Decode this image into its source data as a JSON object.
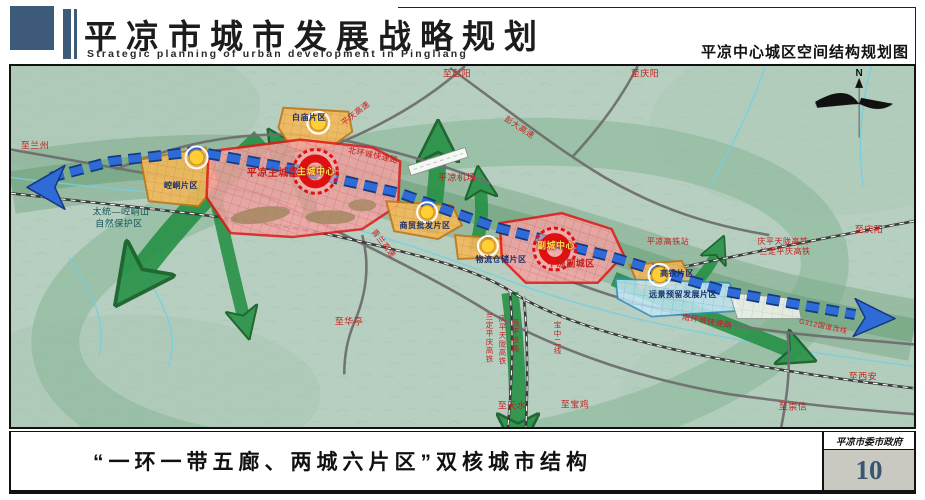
{
  "colors": {
    "red": "#c41f1f",
    "navy": "#1b2f6b",
    "yellow": "#ffe14d",
    "teal": "#15555a",
    "black": "#111111",
    "header_slate": "#3d5b78",
    "page_box_gray": "#c9c9c2",
    "page_number_blue": "#3a5570",
    "zone_orange": "#f3b95c",
    "zone_pink": "#f2a3a3",
    "zone_blue": "#c3e6f4",
    "corridor_green": "#249043",
    "belt_blue": "#2e6bd6"
  },
  "header": {
    "title_cn": "平凉市城市发展战略规划",
    "title_en": "Strategic planning of urban development in Pingliang",
    "map_title": "平凉中心城区空间结构规划图"
  },
  "footer": {
    "caption": "“一环一带五廊、两城六片区”双核城市结构",
    "agency": "平凉市委市政府",
    "page_number": "10"
  },
  "map": {
    "compass": "N",
    "labels": [
      {
        "text": "至兰州",
        "x": 24,
        "y": 80,
        "color": "red",
        "size": 9
      },
      {
        "text": "太统—崆峒山",
        "x": 110,
        "y": 146,
        "color": "teal",
        "size": 9
      },
      {
        "text": "自然保护区",
        "x": 108,
        "y": 158,
        "color": "teal",
        "size": 9
      },
      {
        "text": "崆峒片区",
        "x": 170,
        "y": 120,
        "color": "navy",
        "size": 8,
        "bold": true
      },
      {
        "text": "平凉主城区",
        "x": 262,
        "y": 108,
        "color": "red",
        "size": 10,
        "bold": true
      },
      {
        "text": "主城中心",
        "x": 305,
        "y": 106,
        "color": "yellow",
        "size": 9,
        "bold": true
      },
      {
        "text": "北环城快速路",
        "x": 362,
        "y": 90,
        "color": "red",
        "size": 8,
        "rotate": 12
      },
      {
        "text": "白庙片区",
        "x": 298,
        "y": 52,
        "color": "navy",
        "size": 8,
        "bold": true
      },
      {
        "text": "平庆高速",
        "x": 345,
        "y": 48,
        "color": "red",
        "size": 8,
        "rotate": -38
      },
      {
        "text": "至彭阳",
        "x": 446,
        "y": 8,
        "color": "red",
        "size": 9
      },
      {
        "text": "彭大高速",
        "x": 508,
        "y": 62,
        "color": "red",
        "size": 8,
        "rotate": 33
      },
      {
        "text": "至庆阳",
        "x": 634,
        "y": 8,
        "color": "red",
        "size": 9
      },
      {
        "text": "平凉机场",
        "x": 446,
        "y": 112,
        "color": "red",
        "size": 9
      },
      {
        "text": "青兰高速",
        "x": 372,
        "y": 178,
        "color": "red",
        "size": 8,
        "rotate": 52
      },
      {
        "text": "商贸批发片区",
        "x": 414,
        "y": 160,
        "color": "navy",
        "size": 8,
        "bold": true
      },
      {
        "text": "物流仓储片区",
        "x": 490,
        "y": 194,
        "color": "navy",
        "size": 8,
        "bold": true
      },
      {
        "text": "副城中心",
        "x": 545,
        "y": 180,
        "color": "yellow",
        "size": 9,
        "bold": true
      },
      {
        "text": "平凉副城区",
        "x": 560,
        "y": 198,
        "color": "red",
        "size": 9,
        "bold": true
      },
      {
        "text": "平凉高铁站",
        "x": 657,
        "y": 176,
        "color": "red",
        "size": 8
      },
      {
        "text": "庆平天陇高铁",
        "x": 772,
        "y": 176,
        "color": "red",
        "size": 8
      },
      {
        "text": "兰定平庆高铁",
        "x": 774,
        "y": 186,
        "color": "red",
        "size": 8
      },
      {
        "text": "至庆阳",
        "x": 858,
        "y": 164,
        "color": "red",
        "size": 9
      },
      {
        "text": "高铁片区",
        "x": 666,
        "y": 208,
        "color": "navy",
        "size": 8,
        "bold": true
      },
      {
        "text": "远景预留发展片区",
        "x": 672,
        "y": 229,
        "color": "navy",
        "size": 8,
        "bold": true
      },
      {
        "text": "南环城快速路",
        "x": 696,
        "y": 256,
        "color": "red",
        "size": 8,
        "rotate": 10
      },
      {
        "text": "G312国道改线",
        "x": 812,
        "y": 261,
        "color": "red",
        "size": 7,
        "rotate": 12
      },
      {
        "text": "兰定平庆高铁",
        "x": 478,
        "y": 272,
        "color": "red",
        "size": 7.5,
        "vertical": true
      },
      {
        "text": "庆平天陇高铁",
        "x": 491,
        "y": 274,
        "color": "red",
        "size": 7.5,
        "vertical": true
      },
      {
        "text": "西平铁路",
        "x": 504,
        "y": 270,
        "color": "red",
        "size": 7.5,
        "vertical": true
      },
      {
        "text": "宝中二线",
        "x": 546,
        "y": 272,
        "color": "red",
        "size": 7.5,
        "vertical": true
      },
      {
        "text": "至华亭",
        "x": 338,
        "y": 256,
        "color": "red",
        "size": 9
      },
      {
        "text": "至天水",
        "x": 501,
        "y": 340,
        "color": "red",
        "size": 9
      },
      {
        "text": "至宝鸡",
        "x": 564,
        "y": 339,
        "color": "red",
        "size": 9
      },
      {
        "text": "至崇信",
        "x": 782,
        "y": 341,
        "color": "red",
        "size": 9
      },
      {
        "text": "至西安",
        "x": 852,
        "y": 311,
        "color": "red",
        "size": 9
      }
    ]
  }
}
